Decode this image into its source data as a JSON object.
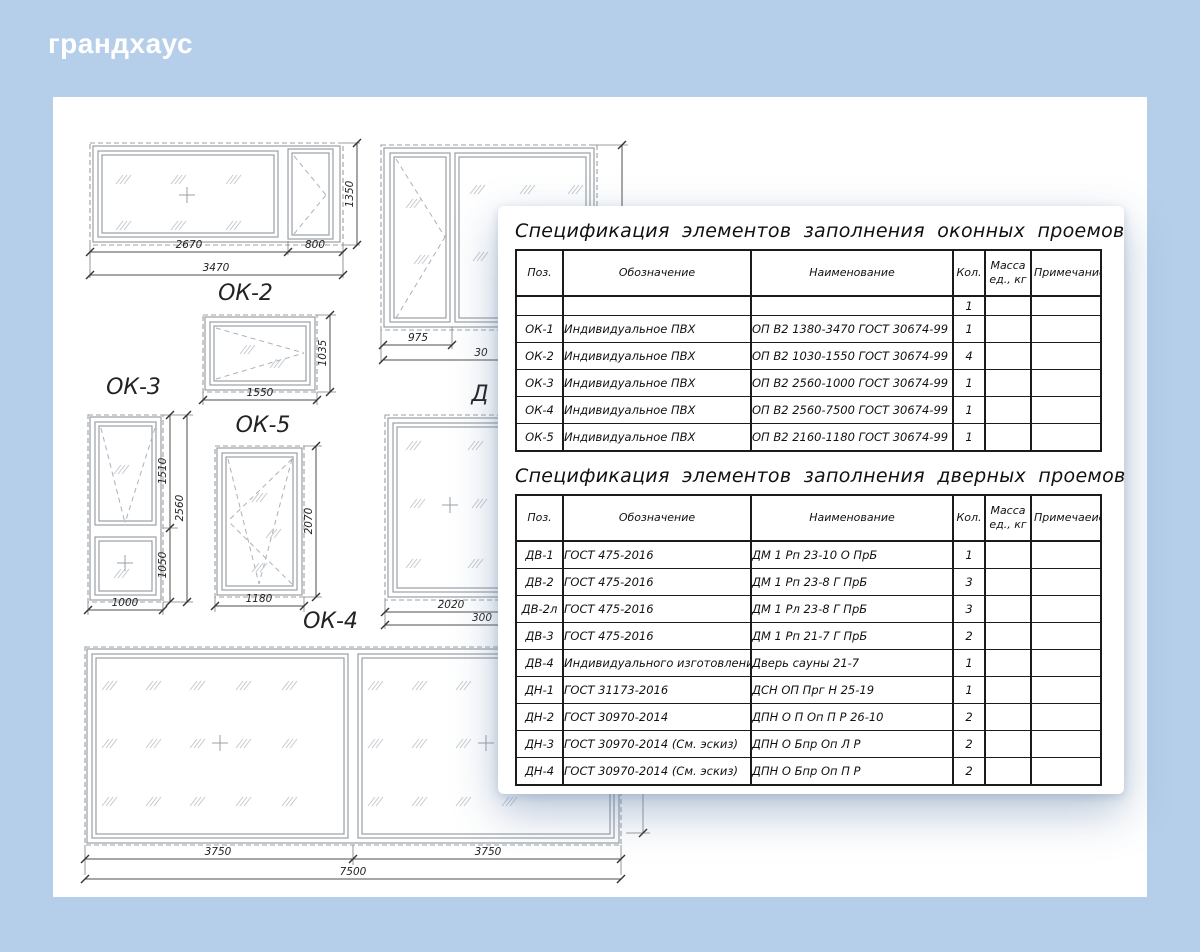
{
  "logo": "грандхаус",
  "colors": {
    "background": "#b5cfea",
    "canvas": "#ffffff",
    "card_shadow": "#5d7ca6",
    "table_border": "#1b1b1b"
  },
  "labels": {
    "a": "ОК-2",
    "c": "ОК-3",
    "d": "ОК-5",
    "e": "ОК-4",
    "f_partial": "Д"
  },
  "dims": {
    "a_w1": "2670",
    "a_w2": "800",
    "a_w": "3470",
    "a_h": "1350",
    "b_w1": "975",
    "b_partial": "30",
    "c_h1": "1510",
    "c_h2": "1050",
    "c_h": "2560",
    "c_w": "1000",
    "d_w": "1550",
    "d_h": "1035",
    "e_w": "1180",
    "e_h": "2070",
    "f_w1": "2020",
    "f_partial": "300",
    "g_w1": "3750",
    "g_w2": "3750",
    "g_w": "7500"
  },
  "tables": {
    "windows": {
      "title": "Спецификация элементов заполнения оконных проемов",
      "headers": {
        "pos": "Поз.",
        "designation": "Обозначение",
        "name": "Наименование",
        "qty": "Кол.",
        "mass": "Масса ед., кг",
        "note": "Примечание"
      },
      "rows": [
        [
          "",
          "",
          "",
          "1",
          "",
          ""
        ],
        [
          "ОК-1",
          "Индивидуальное ПВХ",
          "ОП В2 1380-3470 ГОСТ 30674-99",
          "1",
          "",
          ""
        ],
        [
          "ОК-2",
          "Индивидуальное ПВХ",
          "ОП В2 1030-1550 ГОСТ 30674-99",
          "4",
          "",
          ""
        ],
        [
          "ОК-3",
          "Индивидуальное ПВХ",
          "ОП В2 2560-1000 ГОСТ 30674-99",
          "1",
          "",
          ""
        ],
        [
          "ОК-4",
          "Индивидуальное ПВХ",
          "ОП В2 2560-7500 ГОСТ 30674-99",
          "1",
          "",
          ""
        ],
        [
          "ОК-5",
          "Индивидуальное ПВХ",
          "ОП В2 2160-1180 ГОСТ 30674-99",
          "1",
          "",
          ""
        ]
      ]
    },
    "doors": {
      "title": "Спецификация элементов заполнения дверных проемов",
      "headers": {
        "pos": "Поз.",
        "designation": "Обозначение",
        "name": "Наименование",
        "qty": "Кол.",
        "mass": "Масса ед., кг",
        "note": "Примечаеие"
      },
      "rows": [
        [
          "ДВ-1",
          "ГОСТ 475-2016",
          "ДМ 1 Рп 23-10 О ПрБ",
          "1",
          "",
          ""
        ],
        [
          "ДВ-2",
          "ГОСТ 475-2016",
          "ДМ 1 Рп 23-8 Г ПрБ",
          "3",
          "",
          ""
        ],
        [
          "ДВ-2л",
          "ГОСТ 475-2016",
          "ДМ 1 Рл 23-8 Г ПрБ",
          "3",
          "",
          ""
        ],
        [
          "ДВ-3",
          "ГОСТ 475-2016",
          "ДМ 1 Рп 21-7 Г ПрБ",
          "2",
          "",
          ""
        ],
        [
          "ДВ-4",
          "Индивидуального изготовления",
          "Дверь сауны 21-7",
          "1",
          "",
          ""
        ],
        [
          "ДН-1",
          "ГОСТ 31173-2016",
          "ДСН ОП Прг Н 25-19",
          "1",
          "",
          ""
        ],
        [
          "ДН-2",
          "ГОСТ 30970-2014",
          "ДПН О П Оп П Р 26-10",
          "2",
          "",
          ""
        ],
        [
          "ДН-3",
          "ГОСТ 30970-2014 (См. эскиз)",
          "ДПН О Бпр Оп Л Р",
          "2",
          "",
          ""
        ],
        [
          "ДН-4",
          "ГОСТ 30970-2014 (См. эскиз)",
          "ДПН О Бпр Оп П Р",
          "2",
          "",
          ""
        ]
      ]
    }
  }
}
